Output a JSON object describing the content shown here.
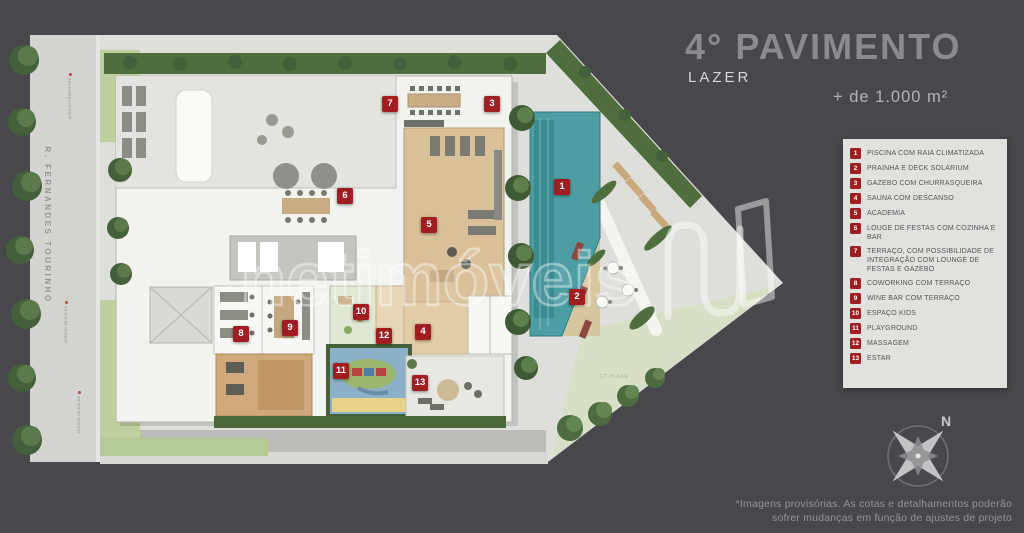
{
  "header": {
    "title": "4° PAVIMENTO",
    "subtitle": "LAZER",
    "area_label": "+ de 1.000 m²"
  },
  "legend": {
    "items": [
      {
        "num": "1",
        "label": "PISCINA COM RAIA CLIMATIZADA"
      },
      {
        "num": "2",
        "label": "PRAINHA E DECK SOLARIUM"
      },
      {
        "num": "3",
        "label": "GAZEBO COM CHURRASQUEIRA"
      },
      {
        "num": "4",
        "label": "SAUNA COM DESCANSO"
      },
      {
        "num": "5",
        "label": "ACADEMIA"
      },
      {
        "num": "6",
        "label": "LOUGE DE FESTAS COM COZINHA E BAR"
      },
      {
        "num": "7",
        "label": "TERRAÇO, COM POSSIBILIDADE DE INTEGRAÇÃO COM LOUNGE DE FESTAS E GAZEBO"
      },
      {
        "num": "8",
        "label": "COWORKING COM TERRAÇO"
      },
      {
        "num": "9",
        "label": "WINE BAR COM TERRAÇO"
      },
      {
        "num": "10",
        "label": "ESPAÇO KIDS"
      },
      {
        "num": "11",
        "label": "PLAYGROUND"
      },
      {
        "num": "12",
        "label": "MASSAGEM"
      },
      {
        "num": "13",
        "label": "ESTAR"
      }
    ]
  },
  "plan": {
    "street_label": "R. FERNANDES TOURINHO",
    "access_labels": [
      {
        "text": "ACESSO PEDESTRES",
        "x": 70,
        "y": 92
      },
      {
        "text": "ACESSO VEÍCULOS",
        "x": 66,
        "y": 318
      },
      {
        "text": "ACESSO VEÍCULOS",
        "x": 79,
        "y": 408
      }
    ],
    "small_labels": [
      {
        "text": "CT PLACE",
        "x": 600,
        "y": 374
      }
    ],
    "markers": [
      {
        "num": "1",
        "x": 562,
        "y": 187
      },
      {
        "num": "2",
        "x": 577,
        "y": 297
      },
      {
        "num": "3",
        "x": 492,
        "y": 104
      },
      {
        "num": "4",
        "x": 423,
        "y": 332
      },
      {
        "num": "5",
        "x": 429,
        "y": 225
      },
      {
        "num": "6",
        "x": 345,
        "y": 196
      },
      {
        "num": "7",
        "x": 390,
        "y": 104
      },
      {
        "num": "8",
        "x": 241,
        "y": 334
      },
      {
        "num": "9",
        "x": 290,
        "y": 328
      },
      {
        "num": "10",
        "x": 361,
        "y": 312
      },
      {
        "num": "11",
        "x": 341,
        "y": 371
      },
      {
        "num": "12",
        "x": 384,
        "y": 336
      },
      {
        "num": "13",
        "x": 420,
        "y": 383
      }
    ]
  },
  "watermark": {
    "text": "netimóveis"
  },
  "compass": {
    "north_label": "N"
  },
  "footnote": {
    "line1": "*Imagens provisórias. As cotas e detalhamentos poderão",
    "line2": "sofrer mudanças em função de ajustes de projeto"
  },
  "colors": {
    "background": "#48484c",
    "accent_red": "#a01d22",
    "legend_bg": "#e1e1dd",
    "pool": "#4d9ea3"
  }
}
